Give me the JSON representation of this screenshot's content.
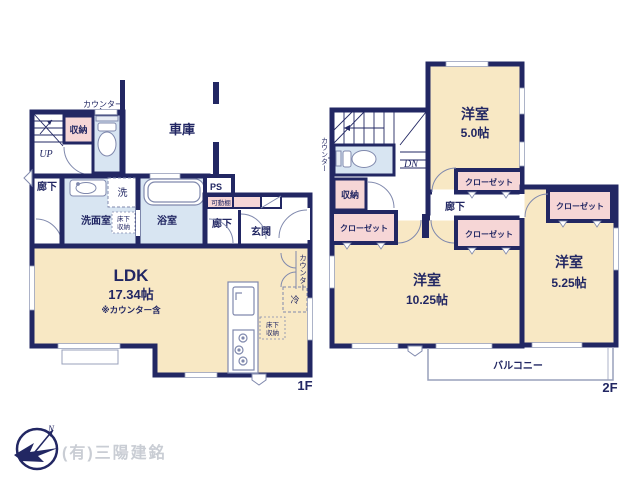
{
  "colors": {
    "wall": "#222763",
    "room_beige": "#f8e8c4",
    "room_blue": "#d8e5f2",
    "room_pink": "#f6d6d6",
    "fixture_line": "#8089ad",
    "watermark_gray": "#c9cdd4"
  },
  "floor1": {
    "floor_label": "1F",
    "ldk": {
      "name": "LDK",
      "size": "17.34帖",
      "note": "※カウンター含"
    },
    "garage": "車庫",
    "entrance": "玄関",
    "hallway": "廊下",
    "washroom": "洗面室",
    "washer": "洗",
    "bathroom": "浴室",
    "storage": "収納",
    "counter": "カウンター",
    "ps": "PS",
    "movable_shelf": "可動棚",
    "underfloor": {
      "line1": "床下",
      "line2": "収納"
    },
    "fridge": "冷",
    "stairs_up": "UP"
  },
  "floor2": {
    "floor_label": "2F",
    "room_a": {
      "name": "洋室",
      "size": "5.0帖"
    },
    "room_b": {
      "name": "洋室",
      "size": "10.25帖"
    },
    "room_c": {
      "name": "洋室",
      "size": "5.25帖"
    },
    "closet": "クローゼット",
    "hallway": "廊下",
    "storage": "収納",
    "counter": "カウンター",
    "stairs_down": "DN",
    "balcony": "バルコニー"
  },
  "footer": {
    "company": "(有)三陽建銘",
    "compass_north": "N"
  }
}
